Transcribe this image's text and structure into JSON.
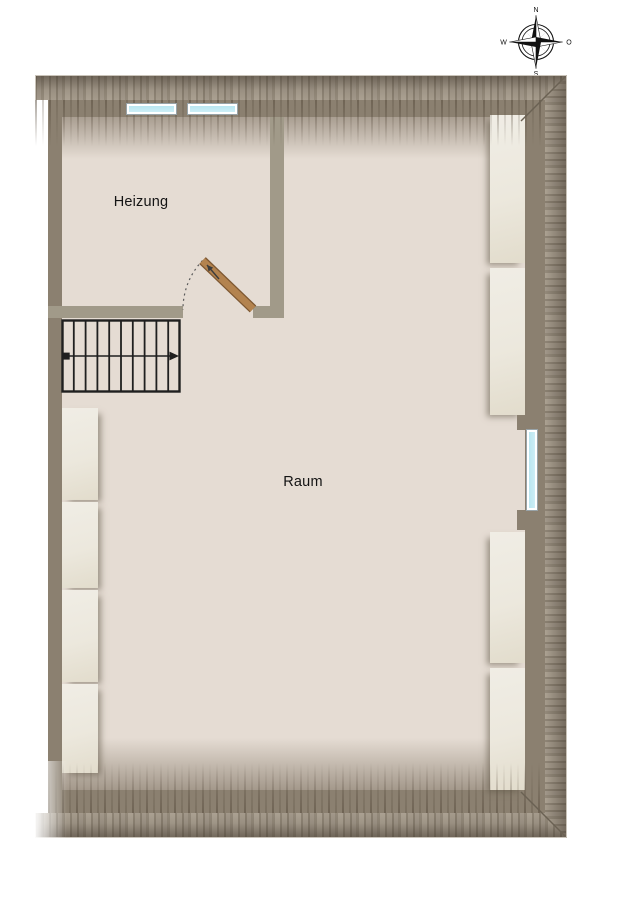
{
  "compass": {
    "north": "N",
    "east": "O",
    "south": "S",
    "west": "W"
  },
  "rooms": {
    "heizung": {
      "label": "Heizung"
    },
    "raum": {
      "label": "Raum"
    }
  },
  "colors": {
    "floor": "#e5dcd3",
    "wall": "#8b8070",
    "partition": "#a19a89",
    "closet": "#f0ede5",
    "window-glass": "#cdeef6",
    "door": "#b3834f",
    "ink": "#1f1f1f"
  }
}
